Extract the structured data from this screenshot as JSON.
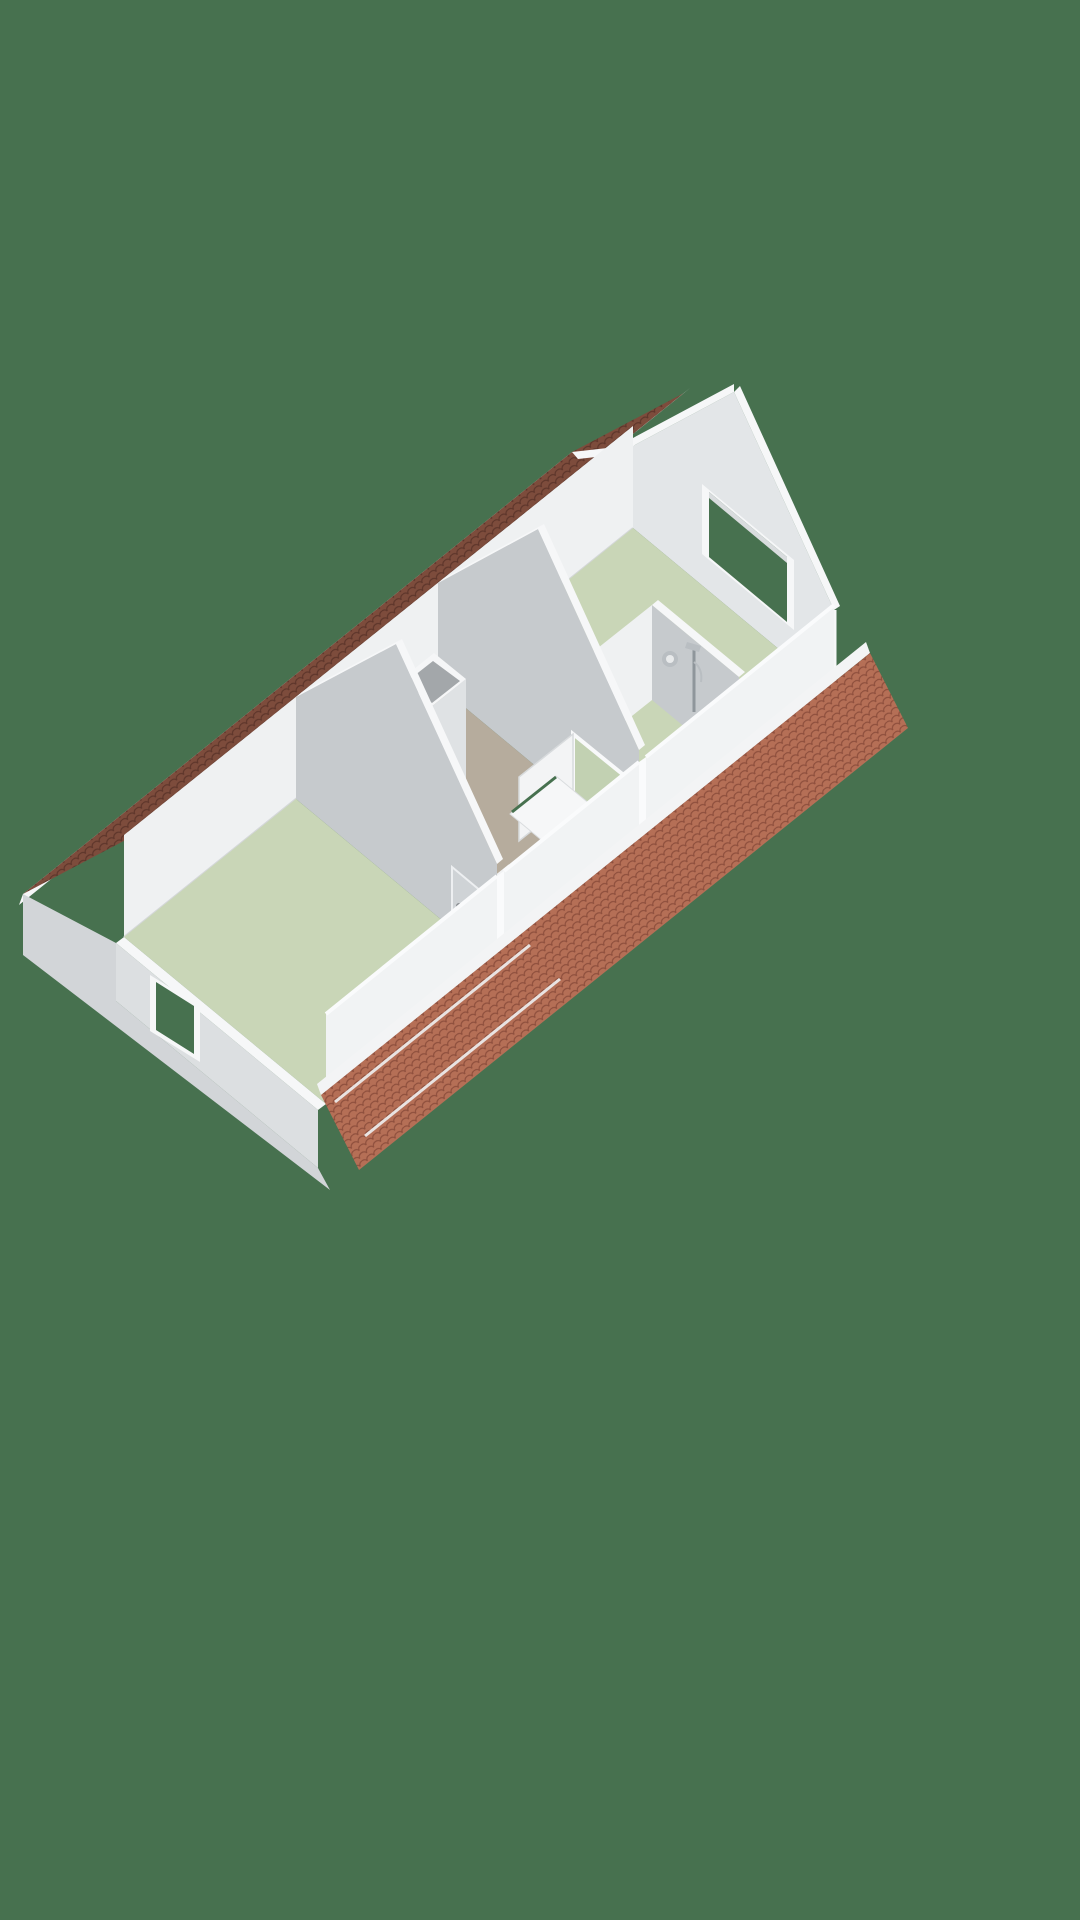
{
  "scene": {
    "type": "3d-floor-plan-render",
    "view": "isometric-overhead",
    "storey": "attic-floor",
    "background_color": "#47714F",
    "rooms": [
      {
        "id": "bedroom-left",
        "floor_color": "#C9D6B7"
      },
      {
        "id": "landing",
        "floor_color": "#B6AC9D"
      },
      {
        "id": "bedroom-right",
        "floor_color": "#C9D6B7"
      },
      {
        "id": "bathroom",
        "floor_color": "#C9D6B7"
      }
    ],
    "features": [
      "tiled-roof-rear-slope",
      "tiled-roof-front-slope",
      "chimney-shaft",
      "stair-opening",
      "stair-balustrade",
      "shower-set",
      "towel-ring",
      "gable-window-left",
      "gable-window-right",
      "interior-door-left-bedroom",
      "interior-door-right-bedroom",
      "bathroom-partition"
    ],
    "colors": {
      "bg": "#47714F",
      "roofDark": "#7D4C3C",
      "roofDarkLine": "#5E362B",
      "roofLight": "#B56F56",
      "roofLightLine": "#8E4F3D",
      "trim": "#F6F7F8",
      "wallWhite": "#EFF1F2",
      "wallLight": "#E3E6E8",
      "wallMid": "#DCDFE1",
      "wallShade": "#C6CACD",
      "wallDeep": "#D2D5D8",
      "floorGreen": "#C9D6B7",
      "floorGreenDeep": "#C2D1B2",
      "floorTaupe": "#B6AC9D",
      "stair": "#0B0B0C",
      "metal": "#8F969B",
      "metalLight": "#B9BEC2",
      "chimneyInner": "#A3A7AA"
    }
  }
}
